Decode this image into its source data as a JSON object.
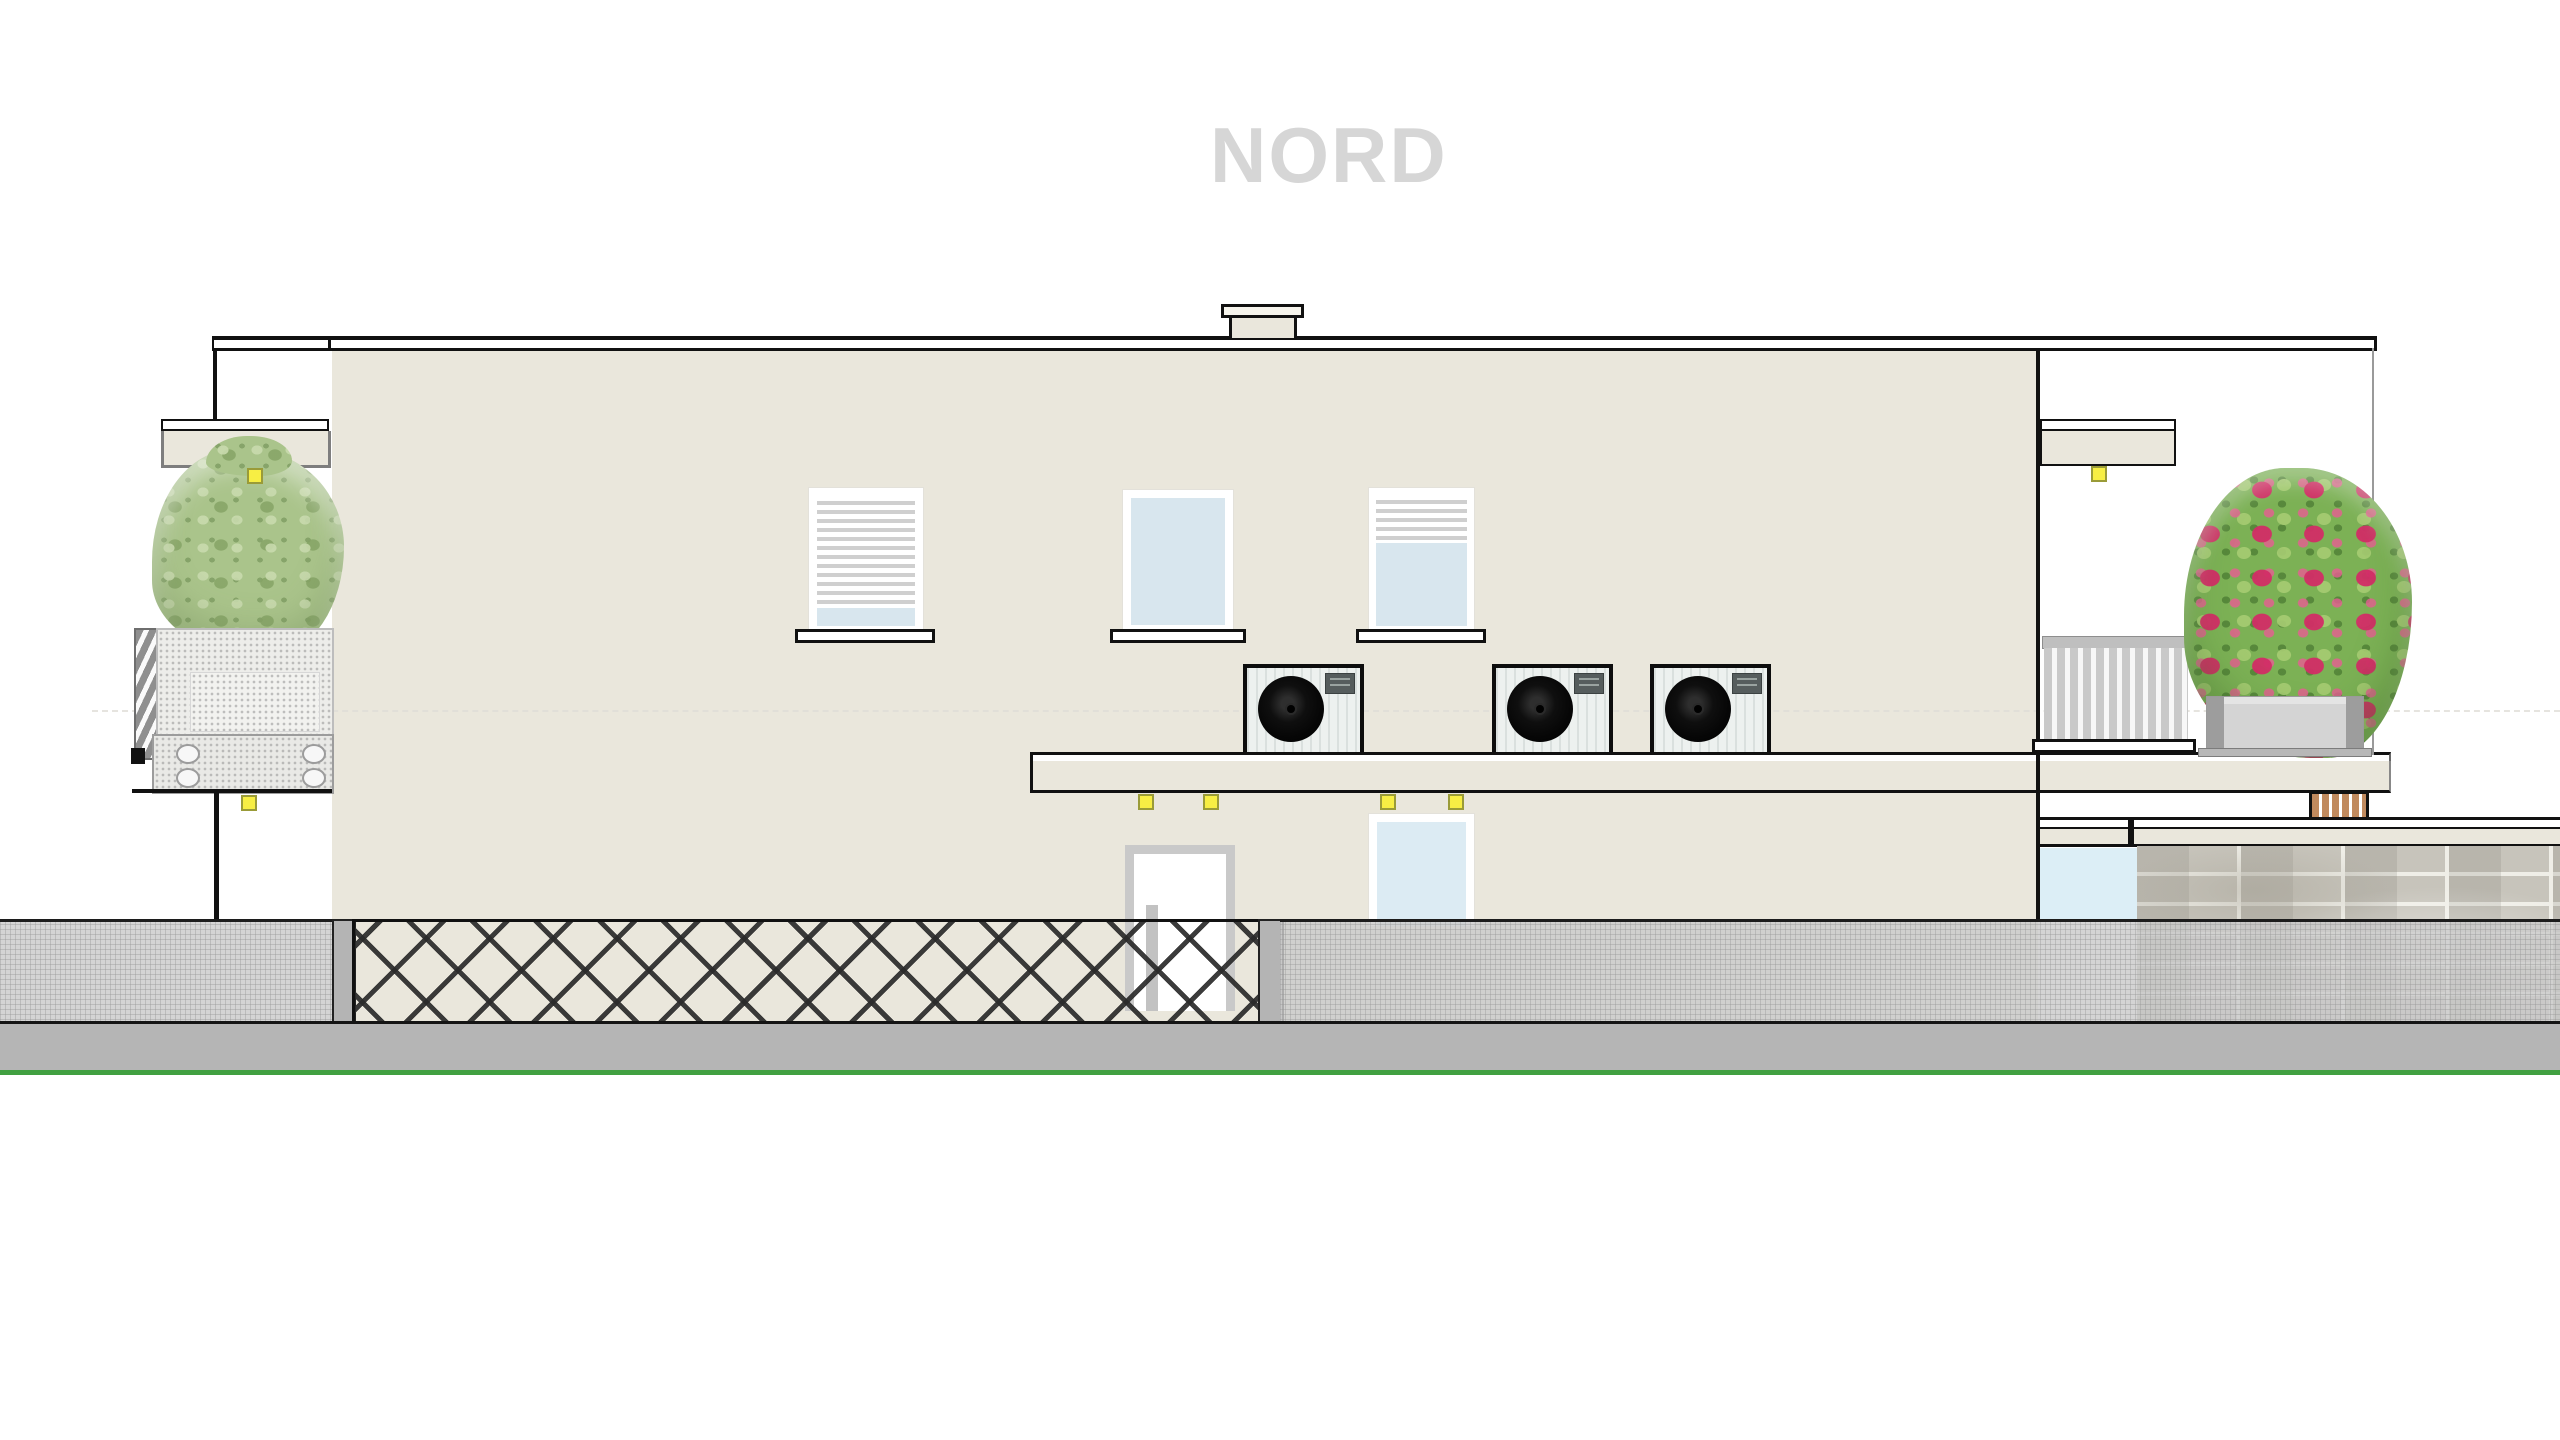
{
  "title": "NORD",
  "drawing": {
    "view_label": "north-facade-elevation",
    "heat_pump_units": 3,
    "upper_windows": 3,
    "windows_with_blinds": 2,
    "ground_floor_door": 1,
    "ground_floor_windows": 2,
    "ceiling_lights": 7,
    "balconies": 2,
    "planters": 2
  },
  "palette": {
    "background": "#ffffff",
    "title_gray": "#d6d6d6",
    "wall_beige": "#eae7dc",
    "outline_black": "#111111",
    "glass_blue": "#d8e6ee",
    "glass_blue_light": "#dceef6",
    "blind_stripe": "#cfcfcf",
    "street_gray": "#b5b5b5",
    "grass_green": "#41a041",
    "light_yellow": "#f7ee44",
    "fence_dark": "#2a2a2a",
    "mesh_gray": "#cbcbcb",
    "post_gray": "#b4b4b4",
    "brick_gray": "#c7c4bb",
    "mortar": "#efeee7",
    "wood_brown": "#c08a5e",
    "railing_gray": "#c9c9c9",
    "planter_gray": "#d4d4d4",
    "bush_green": "#aac48b",
    "oleander_green": "#7cb155",
    "oleander_pink": "#c21f55",
    "unit_body": "#edf1ef",
    "fan_black": "#000000"
  }
}
